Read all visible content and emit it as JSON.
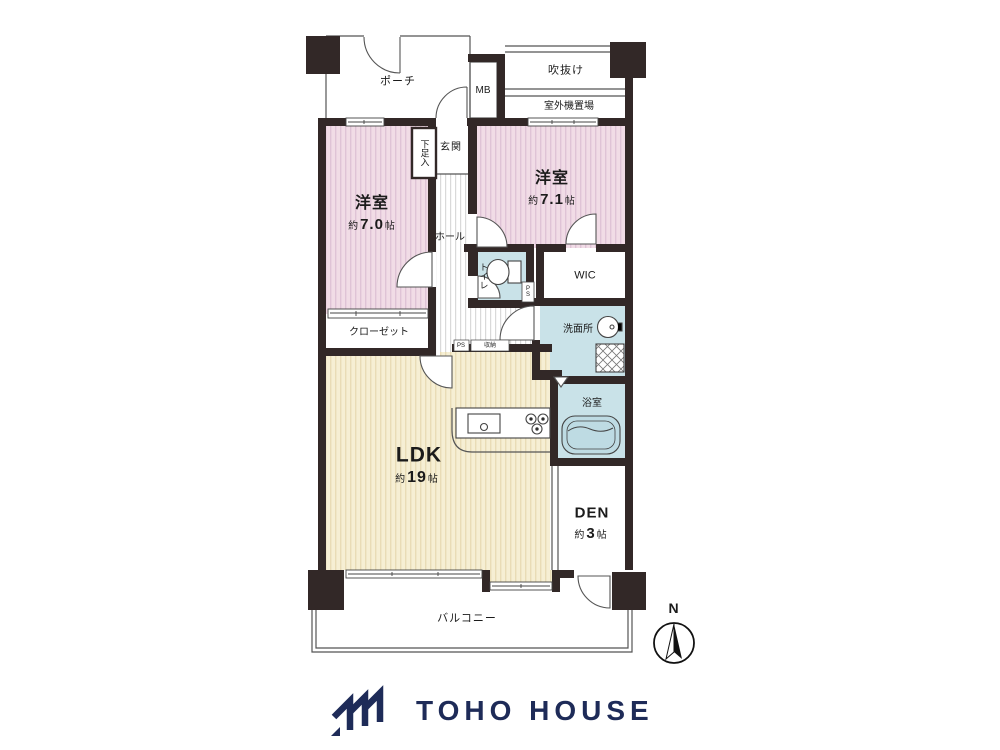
{
  "colors": {
    "wall": "#322827",
    "bedroom_pink": "#f1dce6",
    "bedroom_pink_stripe": "#dfc3d6",
    "ldk_cream": "#f6efd4",
    "ldk_cream_stripe": "#e9dcb6",
    "wet_area_blue": "#c9e2e8",
    "hall_stripe": "#d9d9d9",
    "thin_line": "#555555",
    "brand_navy": "#1e2b58"
  },
  "rooms": {
    "porch": {
      "label": "ポーチ"
    },
    "meter_box": {
      "label": "MB"
    },
    "atrium": {
      "label": "吹抜け"
    },
    "outdoor_unit": {
      "label": "室外機置場"
    },
    "bedroom_left": {
      "label": "洋室",
      "size_prefix": "約",
      "size_num": "7.0",
      "size_unit": "帖"
    },
    "bedroom_right": {
      "label": "洋室",
      "size_prefix": "約",
      "size_num": "7.1",
      "size_unit": "帖"
    },
    "shoe_cabinet": {
      "label": "下足入"
    },
    "entrance": {
      "label": "玄関"
    },
    "hall": {
      "label": "ホール"
    },
    "toilet": {
      "label": "トイレ"
    },
    "pipe_space_toilet": {
      "label": "PS"
    },
    "wic": {
      "label": "WIC"
    },
    "closet": {
      "label": "クローゼット"
    },
    "washroom": {
      "label": "洗面所"
    },
    "pipe_space_ldk": {
      "label": "PS"
    },
    "storage": {
      "label": "収納"
    },
    "bathroom": {
      "label": "浴室"
    },
    "ldk": {
      "label": "LDK",
      "size_prefix": "約",
      "size_num": "19",
      "size_unit": "帖"
    },
    "den": {
      "label": "DEN",
      "size_prefix": "約",
      "size_num": "3",
      "size_unit": "帖"
    },
    "balcony": {
      "label": "バルコニー"
    }
  },
  "compass": {
    "label": "N"
  },
  "brand": {
    "name": "TOHO HOUSE"
  }
}
